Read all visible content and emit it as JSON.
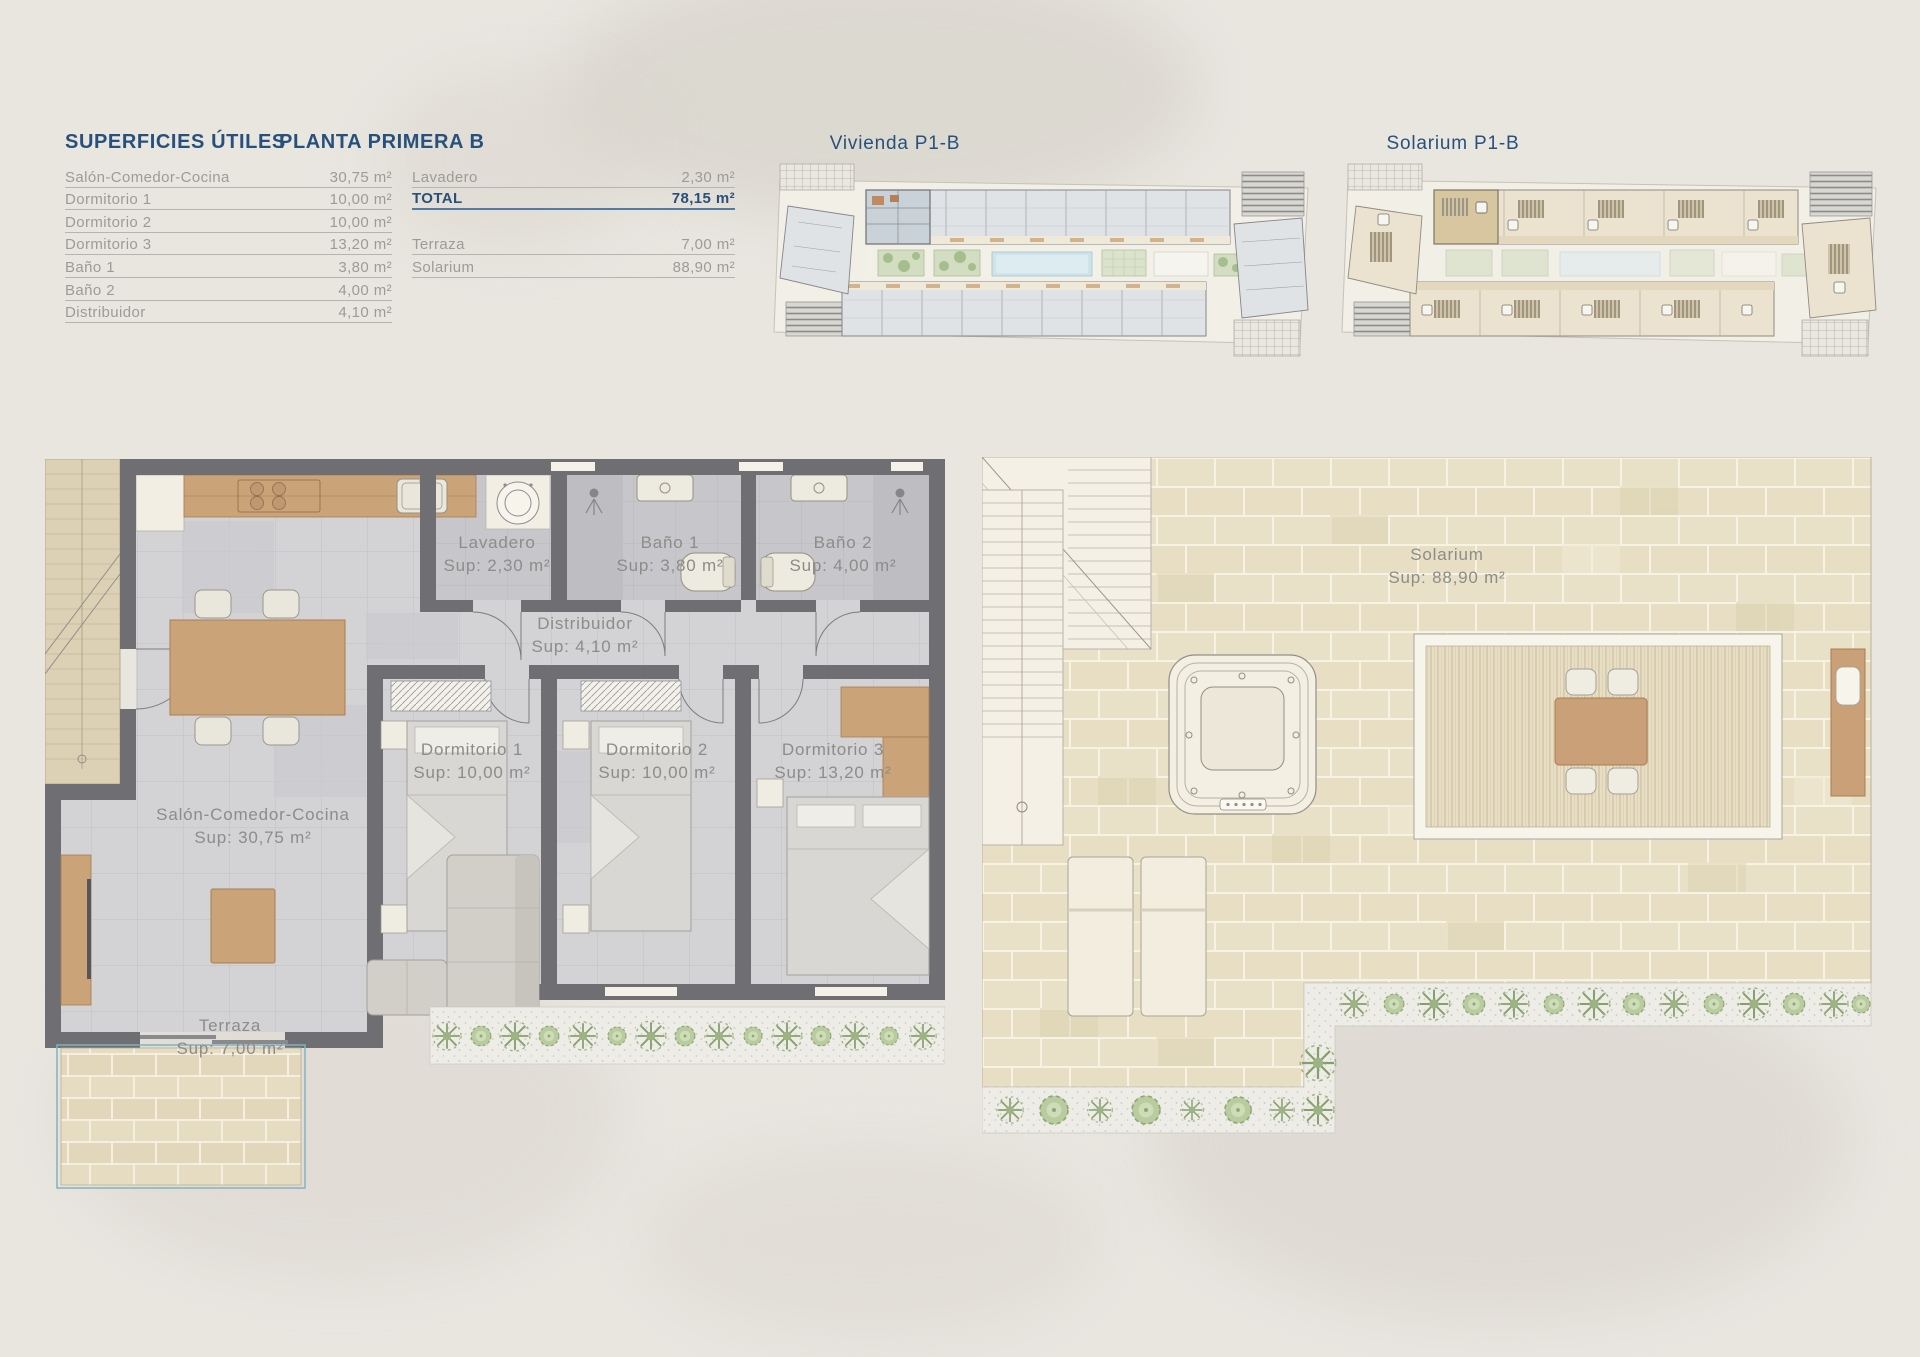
{
  "table": {
    "title": "SUPERFICIES ÚTILES",
    "subtitle": "PLANTA PRIMERA B",
    "rows_left": [
      {
        "label": "Salón-Comedor-Cocina",
        "value": "30,75 m²"
      },
      {
        "label": "Dormitorio 1",
        "value": "10,00 m²"
      },
      {
        "label": "Dormitorio 2",
        "value": "10,00 m²"
      },
      {
        "label": "Dormitorio 3",
        "value": "13,20 m²"
      },
      {
        "label": "Baño 1",
        "value": "3,80 m²"
      },
      {
        "label": "Baño 2",
        "value": "4,00 m²"
      },
      {
        "label": "Distribuidor",
        "value": "4,10 m²"
      }
    ],
    "rows_right": [
      {
        "label": "Lavadero",
        "value": "2,30 m²"
      },
      {
        "label": "TOTAL",
        "value": "78,15 m²"
      },
      {
        "label": "Terraza",
        "value": "7,00 m²"
      },
      {
        "label": "Solarium",
        "value": "88,90 m²"
      }
    ]
  },
  "overview": {
    "vivienda_title": "Vivienda P1-B",
    "solarium_title": "Solarium P1-B"
  },
  "plan": {
    "rooms": [
      {
        "name": "Lavadero",
        "sup": "Sup: 2,30 m²"
      },
      {
        "name": "Baño 1",
        "sup": "Sup: 3,80 m²"
      },
      {
        "name": "Baño 2",
        "sup": "Sup: 4,00 m²"
      },
      {
        "name": "Distribuidor",
        "sup": "Sup: 4,10 m²"
      },
      {
        "name": "Dormitorio 1",
        "sup": "Sup: 10,00 m²"
      },
      {
        "name": "Dormitorio 2",
        "sup": "Sup: 10,00 m²"
      },
      {
        "name": "Dormitorio 3",
        "sup": "Sup: 13,20 m²"
      },
      {
        "name": "Salón-Comedor-Cocina",
        "sup": "Sup: 30,75 m²"
      },
      {
        "name": "Terraza",
        "sup": "Sup: 7,00 m²"
      }
    ]
  },
  "solarium": {
    "name": "Solarium",
    "sup": "Sup: 88,90 m²"
  },
  "colors": {
    "accent_navy": "#27517c",
    "wall_gray": "#6f6f73",
    "wood": "#c9a077",
    "tile_beige": "#e7dec4",
    "plant_green": "#a9c08f",
    "pool_blue": "#cfe3ea",
    "text_gray": "#9c9b97"
  }
}
